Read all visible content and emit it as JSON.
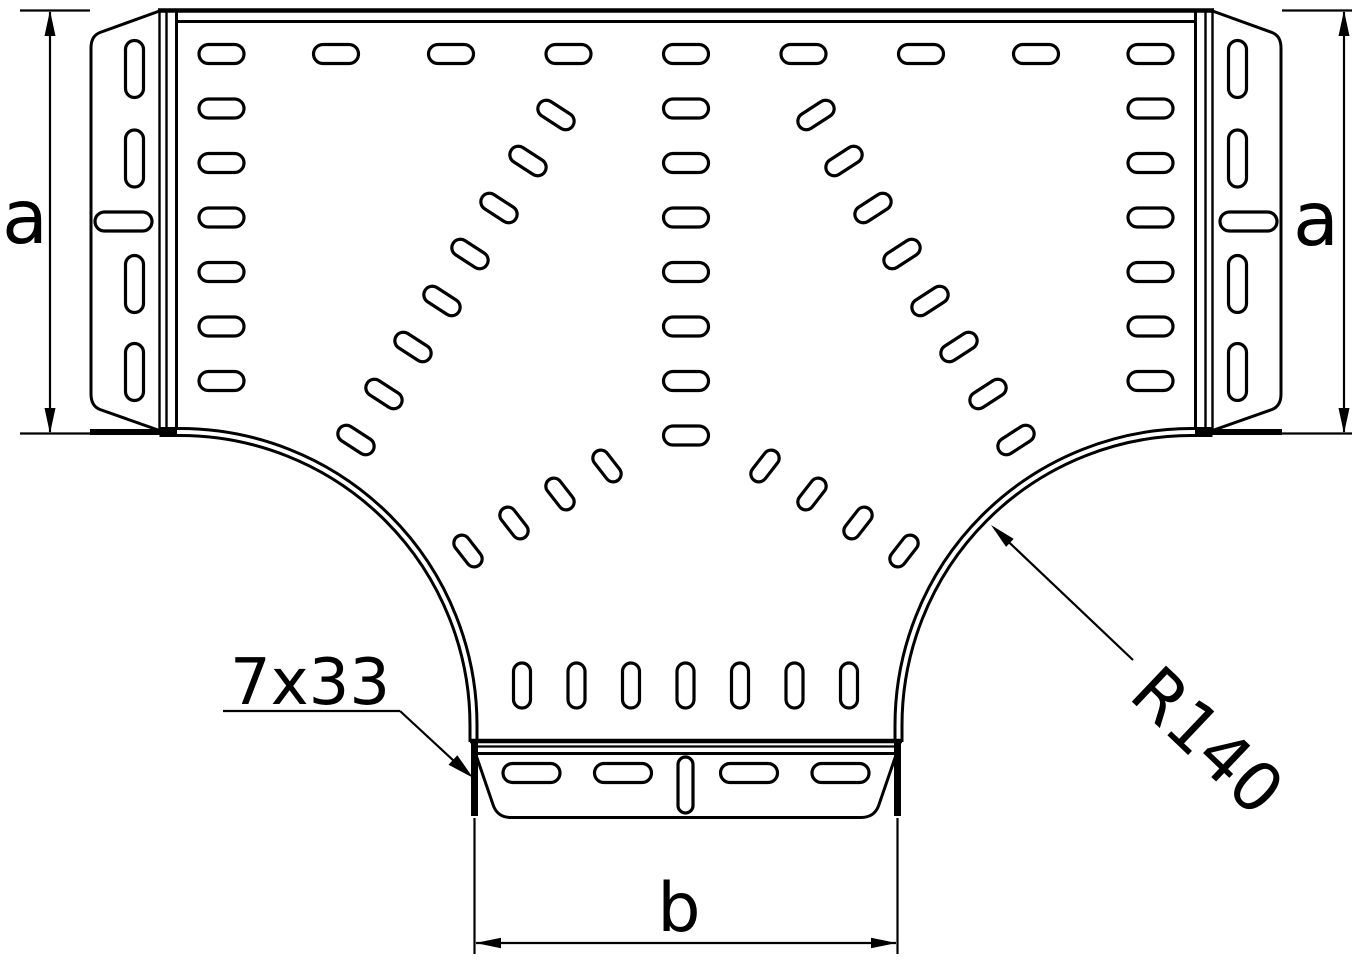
{
  "drawing": {
    "labels": {
      "dim_side_left": "a",
      "dim_side_right": "a",
      "dim_bottom": "b",
      "slot_pattern_note": "7x33",
      "radius_note": "R140"
    },
    "colors": {
      "line": "#000000",
      "background": "#ffffff"
    }
  }
}
